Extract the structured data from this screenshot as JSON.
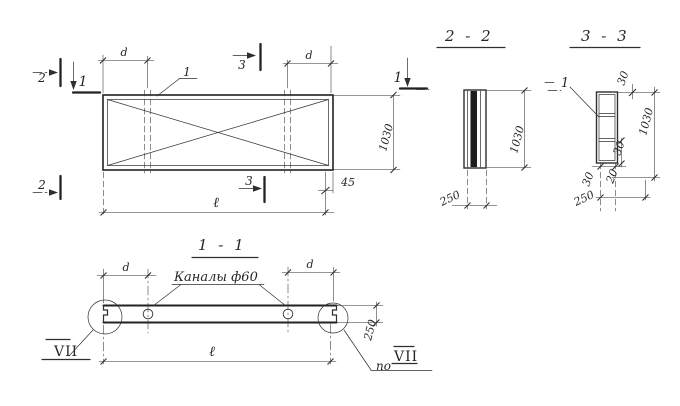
{
  "plan": {
    "cut_2": "2",
    "cut_1": "1",
    "cut_3": "3",
    "callout": "1",
    "dim_d": "d",
    "dim_height": "1030",
    "dim_length": "ℓ",
    "dim_45": "45"
  },
  "section_2_2": {
    "title": "2 - 2",
    "dim_height": "1030",
    "dim_width": "250"
  },
  "section_3_3": {
    "title": "3 - 3",
    "callout": "1",
    "dim_top": "30",
    "dim_height": "1030",
    "dim_rung": "30",
    "dim_bottom_left": "30",
    "dim_bottom_right": "20",
    "dim_width": "250"
  },
  "section_1_1": {
    "title": "1 - 1",
    "channels_label": "Каналы ф60",
    "dim_d": "d",
    "dim_thickness": "250",
    "dim_length": "ℓ",
    "detail_label": "VII",
    "detail_ref_prefix": "по",
    "detail_ref_label": "VII"
  }
}
